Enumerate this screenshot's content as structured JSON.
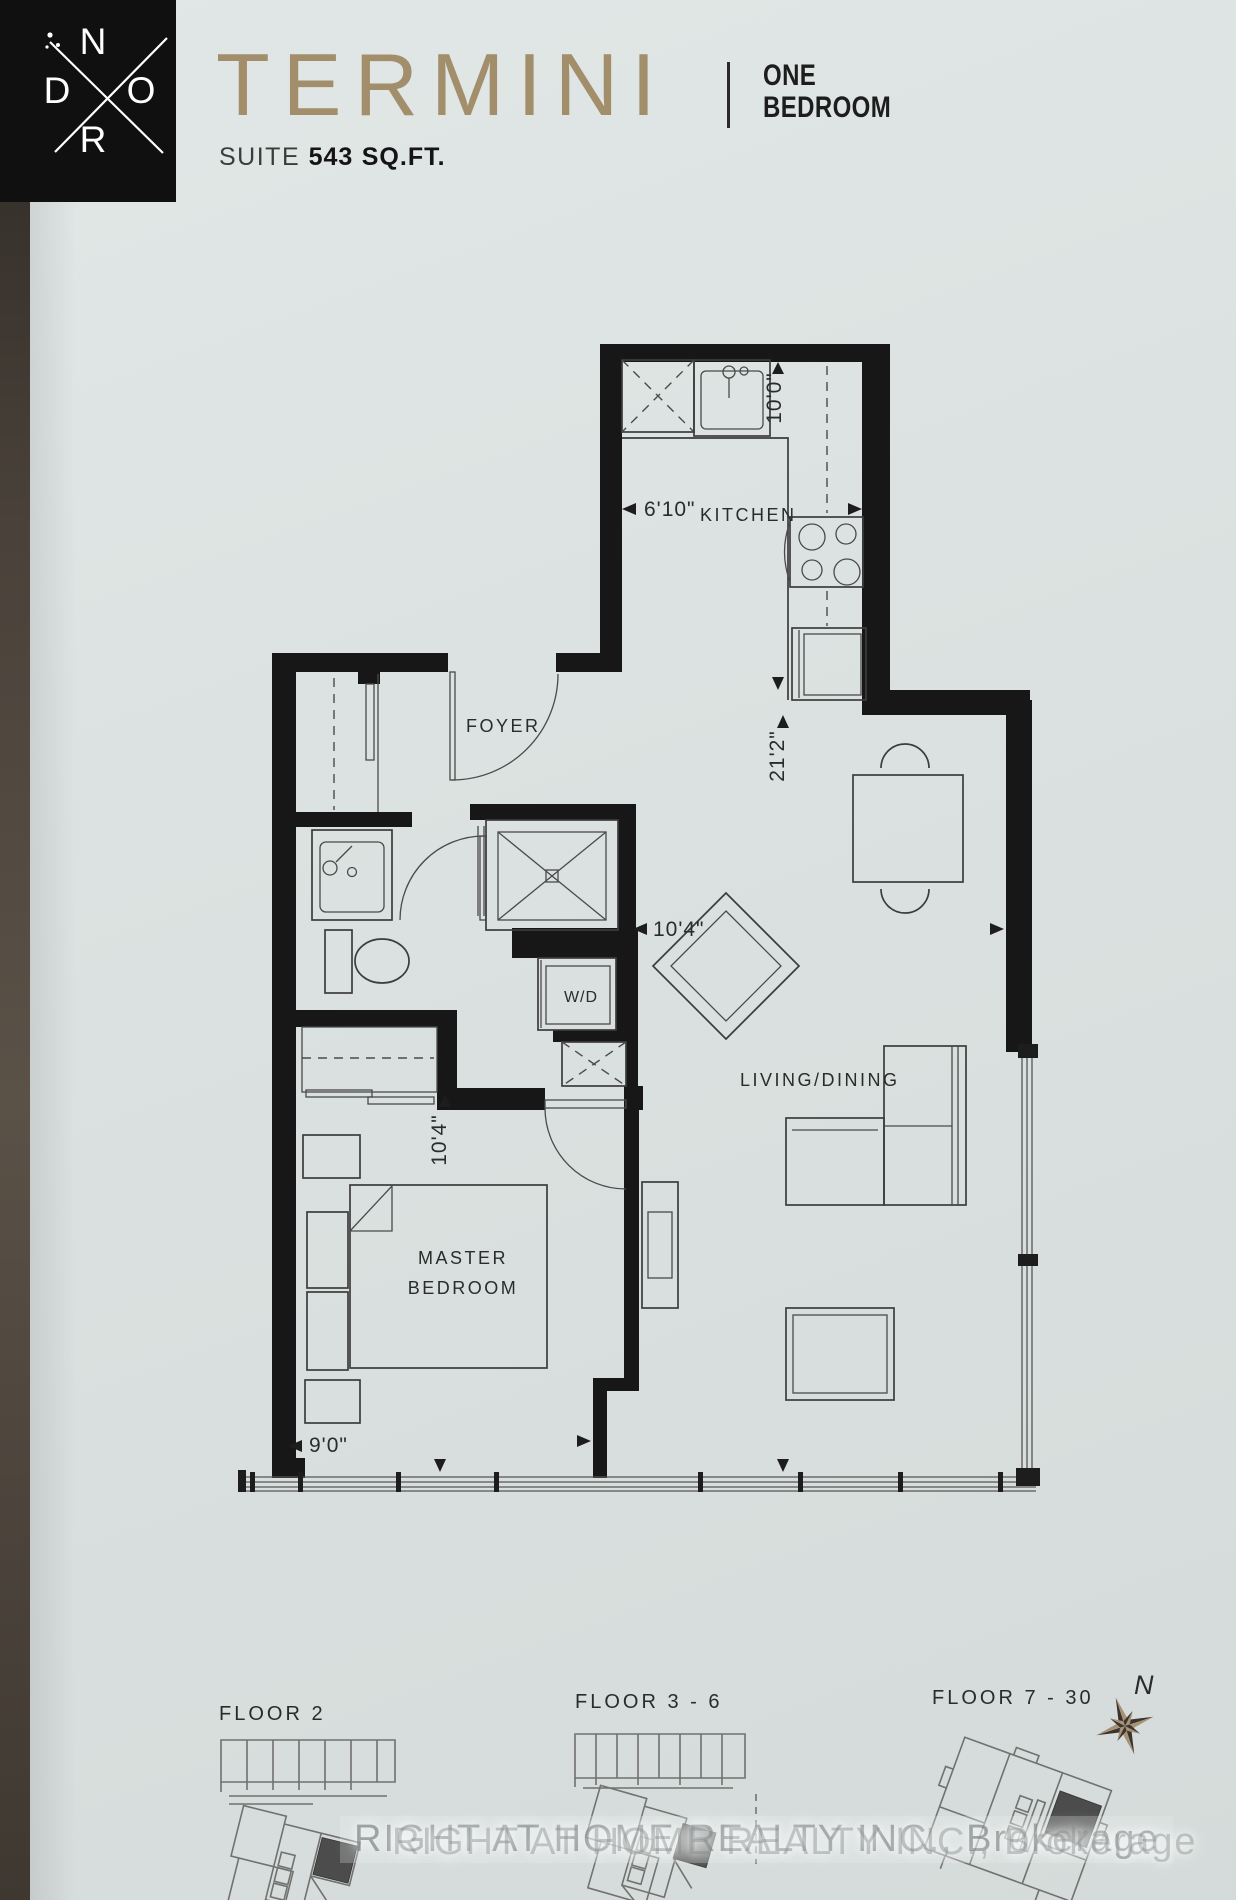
{
  "header": {
    "logo": {
      "n": "N",
      "d": "D",
      "o": "O",
      "r": "R"
    },
    "title": "TERMINI",
    "type_line1": "ONE",
    "type_line2": "BEDROOM",
    "suite_label": "SUITE",
    "suite_area": "543",
    "suite_unit": "SQ.FT."
  },
  "plan": {
    "labels": {
      "kitchen": "KITCHEN",
      "foyer": "FOYER",
      "wd": "W/D",
      "living": "LIVING/DINING",
      "master1": "MASTER",
      "master2": "BEDROOM"
    },
    "dims": {
      "kitchen_depth": "10'0\"",
      "kitchen_width": "6'10\"",
      "living_depth": "21'2\"",
      "living_width": "10'4\"",
      "bedroom_depth": "10'4\"",
      "bedroom_width": "9'0\""
    }
  },
  "keyplans": {
    "floor2": "FLOOR 2",
    "floor3_6": "FLOOR 3 - 6",
    "floor7_30": "FLOOR 7 - 30",
    "compass_north": "N"
  },
  "watermark": "RIGHT AT HOME REALTY INC., Brokerage",
  "colors": {
    "title": "#a28e6b",
    "paper": "#dce2e1",
    "wall": "#171717",
    "keyplan_highlight": "#4c4c4c"
  }
}
